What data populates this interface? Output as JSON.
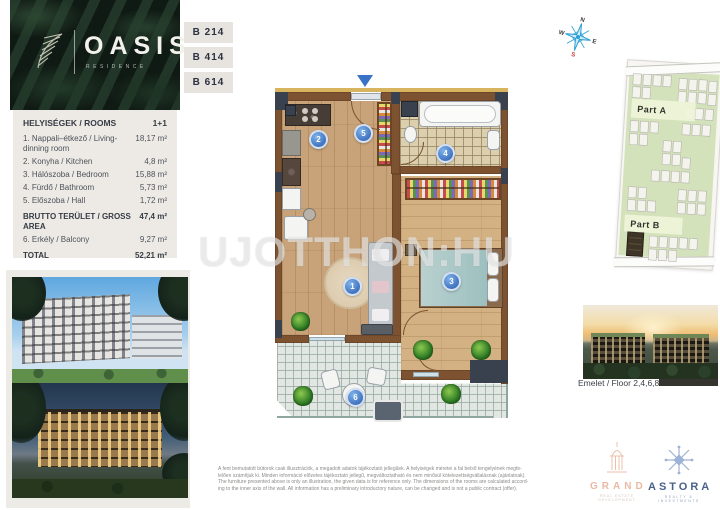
{
  "logo": {
    "title": "OASIS",
    "subtitle": "RESIDENCE"
  },
  "unit_badges": [
    {
      "label": "B 214"
    },
    {
      "label": "B 414"
    },
    {
      "label": "B 614"
    }
  ],
  "rooms_table": {
    "header_label": "HELYISÉGEK / ROOMS",
    "header_value": "1+1",
    "rows": [
      {
        "label": "1. Nappali–étkező / Living-dinning room",
        "value": "18,17 m²"
      },
      {
        "label": "2. Konyha / Kitchen",
        "value": "4,8 m²"
      },
      {
        "label": "3. Hálószoba / Bedroom",
        "value": "15,88 m²"
      },
      {
        "label": "4. Fürdő / Bathroom",
        "value": "5,73 m²"
      },
      {
        "label": "5. Előszoba / Hall",
        "value": "1,72 m²"
      }
    ],
    "gross_label": "BRUTTO TERÜLET / GROSS AREA",
    "gross_value": "47,4 m²",
    "balcony_label": "6. Erkély / Balcony",
    "balcony_value": "9,27 m²",
    "total_label": "TOTAL",
    "total_value": "52,21 m²"
  },
  "floor_plan": {
    "room_numbers": [
      "1",
      "2",
      "3",
      "4",
      "5",
      "6"
    ]
  },
  "watermark": "UJOTTHON:HU",
  "compass": {
    "n": "N",
    "e": "E",
    "s": "S",
    "w": "W"
  },
  "site_plan": {
    "part_a": "Part A",
    "part_b": "Part B"
  },
  "floor_label": "Emelet / Floor 2,4,6,8",
  "disclaimer": [
    "A fent bemutatott bútorok csak illusztrációk, a megadott adatok tájékoztató jellegűek. A helyiségek méretei a fal belső tengelyének megfe-",
    "lelően számítjuk ki. Minden információ előzetes tájékoztató jellegű, megváltoztatható és nem minősül kötelezettségvállalásnak (ajánlatnak).",
    "The furniture presented above is only an illustration, the given data is for reference only. The dimensions of the rooms are calculated accord-",
    "ing to the inner axis of the wall. All information has a preliminary introductory nature, can be changed and is not a public contract (offer)."
  ],
  "brand_logos": {
    "grand": {
      "name": "GRAND",
      "tagline": "REAL ESTATE DEVELOPMENT"
    },
    "astora": {
      "name": "ASTORA",
      "tagline": "REALTY & INVESTMENTS"
    }
  },
  "colors": {
    "accent_blue": "#3d6fbe",
    "wall_brown": "#7c5231",
    "logo_green": "#15221a",
    "site_green": "#d3e2bb",
    "grand_pink": "#eab9a2",
    "astora_blue": "#49618b"
  }
}
